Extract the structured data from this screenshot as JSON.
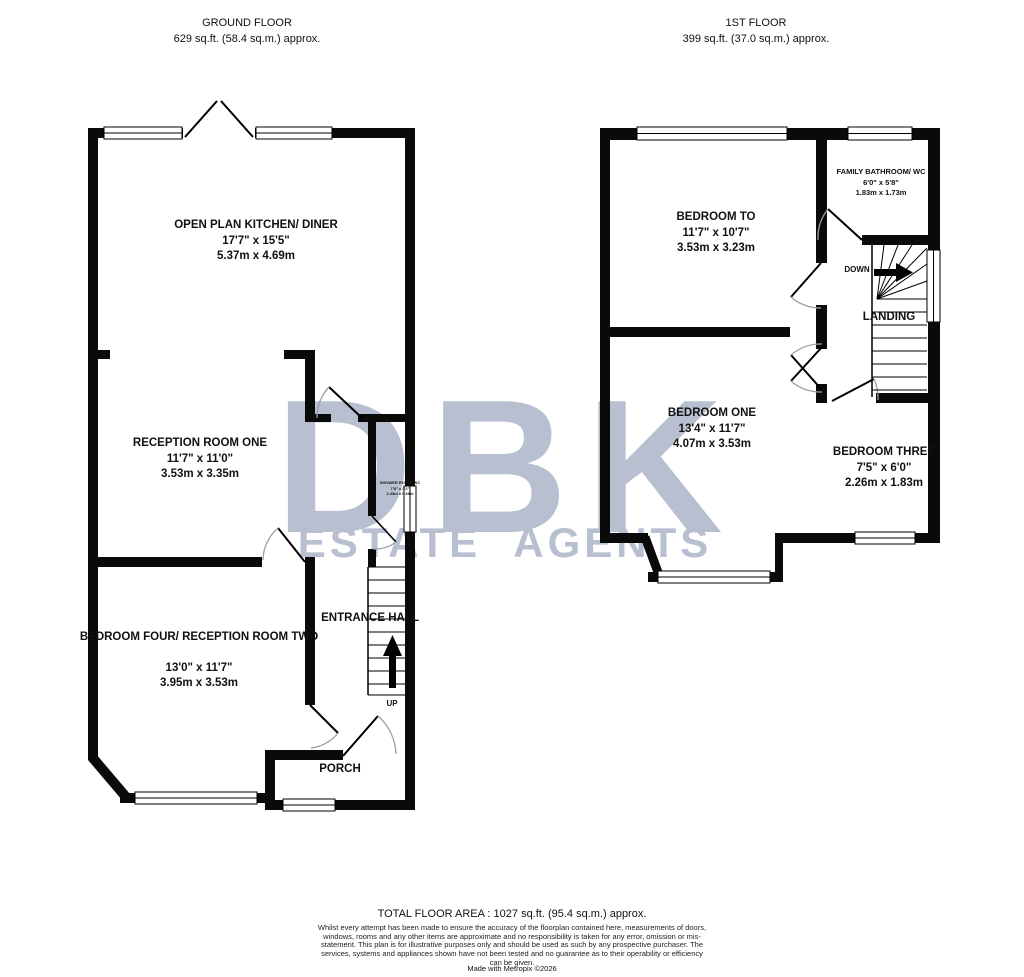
{
  "watermark": {
    "line1": "DBK",
    "line2": "ESTATE AGENTS",
    "color": "#b7bfd0"
  },
  "ground_floor": {
    "title": "GROUND FLOOR",
    "area": "629 sq.ft. (58.4 sq.m.) approx.",
    "kitchen": {
      "name": "OPEN PLAN KITCHEN/ DINER",
      "imperial": "17'7\" x 15'5\"",
      "metric": "5.37m x 4.69m"
    },
    "reception_one": {
      "name": "RECEPTION ROOM ONE",
      "imperial": "11'7\" x 11'0\"",
      "metric": "3.53m x 3.35m"
    },
    "shower_room": {
      "name": "SHOWER ROOM/ WC",
      "imperial": "7'8\" x 2'2\"",
      "metric": "2.33m x 0.66m"
    },
    "bedroom_four": {
      "name": "BEDROOM FOUR/ RECEPTION ROOM TWO",
      "imperial": "13'0\" x 11'7\"",
      "metric": "3.95m x 3.53m"
    },
    "entrance_hall": {
      "name": "ENTRANCE HALL"
    },
    "porch": {
      "name": "PORCH"
    },
    "stairs_label": "UP"
  },
  "first_floor": {
    "title": "1ST FLOOR",
    "area": "399 sq.ft. (37.0 sq.m.) approx.",
    "bedroom_two": {
      "name": "BEDROOM TO",
      "imperial": "11'7\" x 10'7\"",
      "metric": "3.53m x 3.23m"
    },
    "family_bathroom": {
      "name": "FAMILY BATHROOM/ WC",
      "imperial": "6'0\" x 5'8\"",
      "metric": "1.83m x 1.73m"
    },
    "bedroom_one": {
      "name": "BEDROOM ONE",
      "imperial": "13'4\" x 11'7\"",
      "metric": "4.07m x 3.53m"
    },
    "bedroom_three": {
      "name": "BEDROOM THREE",
      "imperial": "7'5\" x 6'0\"",
      "metric": "2.26m x 1.83m"
    },
    "landing": {
      "name": "LANDING"
    },
    "stairs_label": "DOWN"
  },
  "footer": {
    "total_area": "TOTAL FLOOR AREA : 1027 sq.ft. (95.4 sq.m.) approx.",
    "disclaimer": "Whilst every attempt has been made to ensure the accuracy of the floorplan contained here, measurements of doors, windows, rooms and any other items are approximate and no responsibility is taken for any error, omission or mis-statement. This plan is for illustrative purposes only and should be used as such by any prospective purchaser. The services, systems and appliances shown have not been tested and no guarantee as to their operability or efficiency can be given.",
    "credit": "Made with Metropix ©2026"
  }
}
